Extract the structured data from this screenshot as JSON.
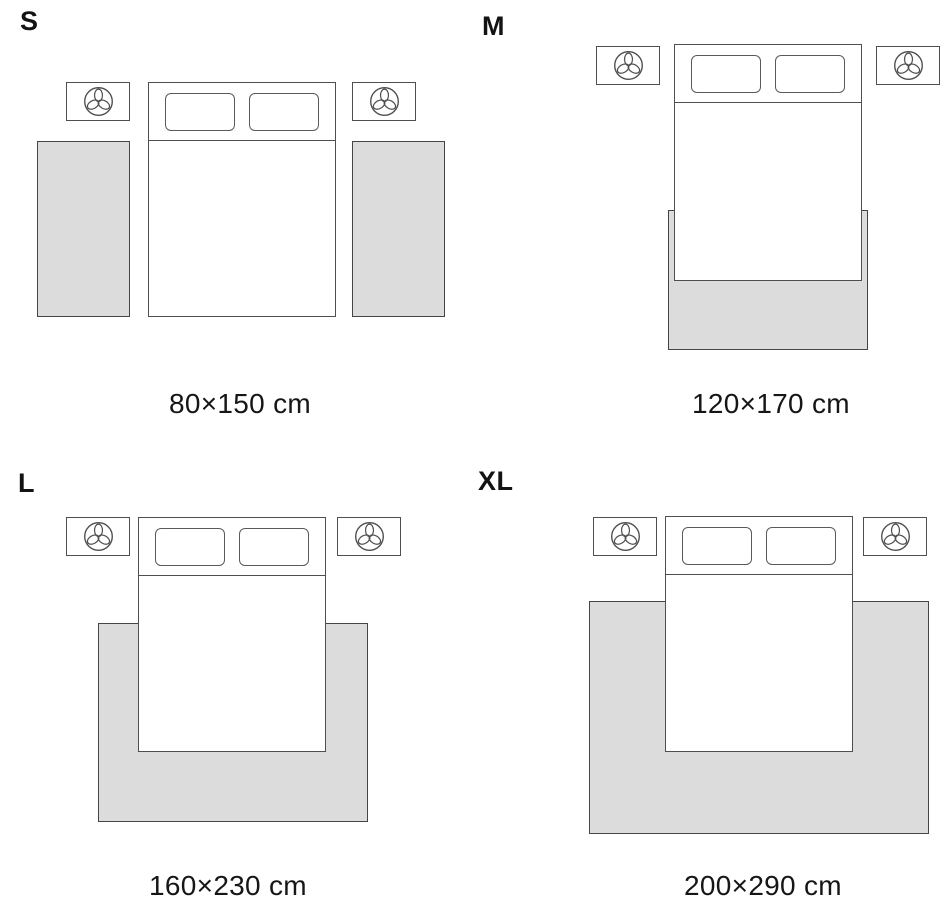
{
  "title": "Rug size guide — bedroom placement diagram",
  "colors": {
    "background": "#ffffff",
    "rug_fill": "#dcdcdc",
    "outline": "#4f4f4f",
    "text": "#161616"
  },
  "icons": {
    "nightstand_icon": "plant-icon"
  },
  "panels": [
    {
      "id": "s",
      "label": "S",
      "dimensions": "80×150 cm",
      "layout": "two side runner rugs beside bed"
    },
    {
      "id": "m",
      "label": "M",
      "dimensions": "120×170 cm",
      "layout": "rug under foot of bed, slight side overhang"
    },
    {
      "id": "l",
      "label": "L",
      "dimensions": "160×230 cm",
      "layout": "rug under lower two-thirds of bed, wide overhang"
    },
    {
      "id": "xl",
      "label": "XL",
      "dimensions": "200×290 cm",
      "layout": "extra-wide rug under bed reaching past nightstand line"
    }
  ]
}
